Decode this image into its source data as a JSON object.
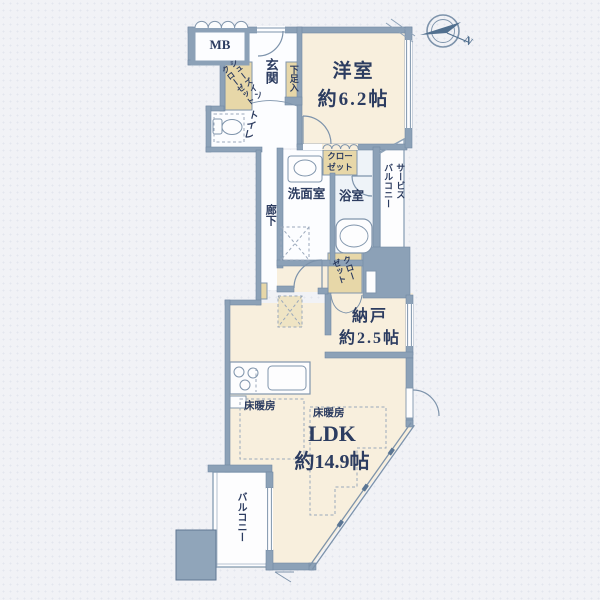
{
  "floorplan": {
    "compass": {
      "north": "N"
    },
    "rooms": {
      "mb": "MB",
      "shoes_closet": "シューズイン\nクローゼット",
      "entrance": "玄関",
      "shoe_box": "下足入",
      "toilet": "トイレ",
      "western_room_name": "洋室",
      "western_room_size": "約6.2帖",
      "closet_west": "クロー\nゼット",
      "washroom": "洗面室",
      "bathroom": "浴室",
      "service_balcony": "サービス\nバルコニー",
      "corridor": "廊下",
      "closet_storage": "クロー\nゼット",
      "storage_name": "納戸",
      "storage_size": "約2.5帖",
      "floor_heating_1": "床暖房",
      "floor_heating_2": "床暖房",
      "ldk_name": "LDK",
      "ldk_size": "約14.9帖",
      "balcony": "バルコニー"
    },
    "colors": {
      "wall": "#8ca1b7",
      "room_cream": "#f8efdd",
      "closet_tan": "#e7d7a8",
      "bath_blue": "#eef3f8",
      "white_room": "#fcfdff",
      "line": "#7d93ab",
      "text": "#2c3c60"
    }
  }
}
